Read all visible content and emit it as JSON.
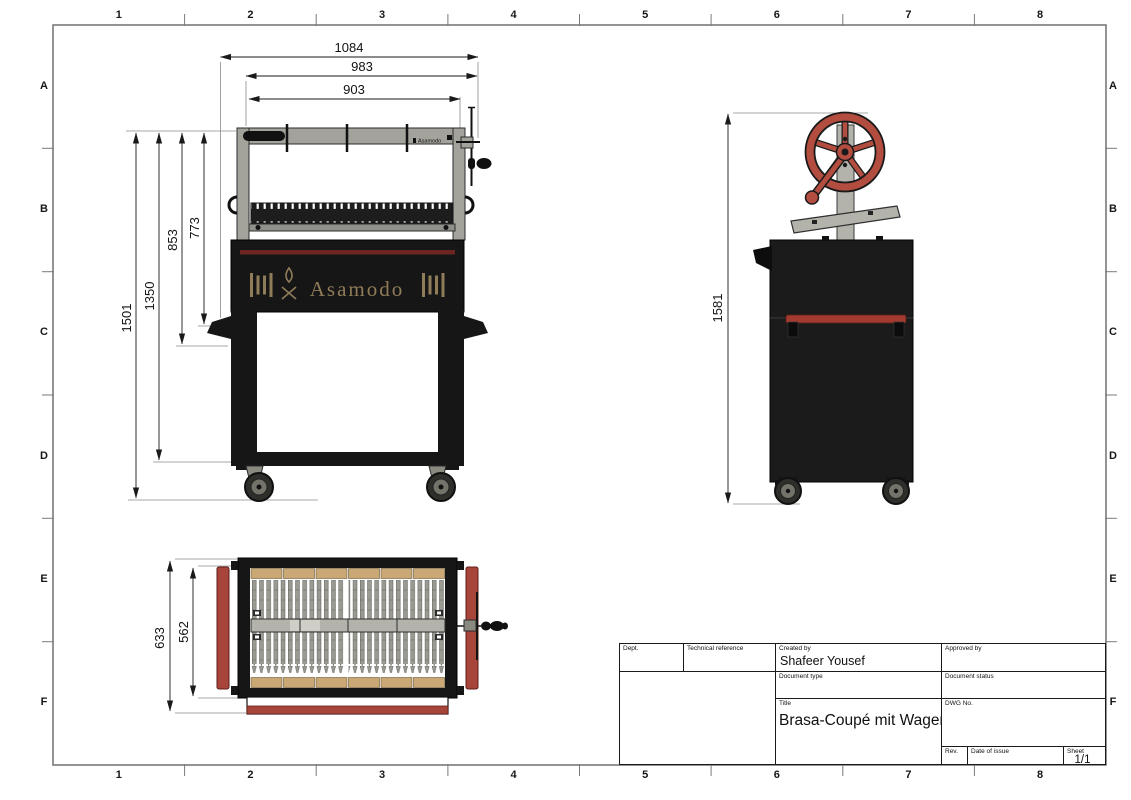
{
  "sheet": {
    "grid_cols": [
      "1",
      "2",
      "3",
      "4",
      "5",
      "6",
      "7",
      "8"
    ],
    "grid_rows": [
      "A",
      "B",
      "C",
      "D",
      "E",
      "F"
    ]
  },
  "views": {
    "front_view": {
      "horizontal_dimensions": [
        "1084",
        "983",
        "903"
      ],
      "vertical_dimensions": [
        "1501",
        "1350",
        "853",
        "773"
      ],
      "logo_text": "Asamodo",
      "top_bar_brand": "Asamodo"
    },
    "side_view": {
      "vertical_dimensions": [
        "1581"
      ]
    },
    "top_view": {
      "vertical_dimensions": [
        "633",
        "562"
      ]
    }
  },
  "title_block": {
    "dept_label": "Dept.",
    "technical_reference_label": "Technical reference",
    "created_by_label": "Created by",
    "created_by_value": "Shafeer Yousef",
    "approved_by_label": "Approved by",
    "document_type_label": "Document type",
    "document_status_label": "Document status",
    "title_label": "Title",
    "title_value": "Brasa-Coupé mit Wagen",
    "dwg_no_label": "DWG No.",
    "rev_label": "Rev.",
    "date_of_issue_label": "Date of issue",
    "sheet_label": "Sheet",
    "sheet_value": "1/1"
  },
  "colors": {
    "wheel_red": "#b34d40",
    "handle_red": "#a8453a",
    "firebox_stripe_red": "#6e2521",
    "logo_tan": "#8f7c58",
    "wood_tan": "#c9a876",
    "metal_gray": "#a9a9a1",
    "body_black": "#1a1a1a",
    "frame_line_gray": "#7a7a7a"
  }
}
